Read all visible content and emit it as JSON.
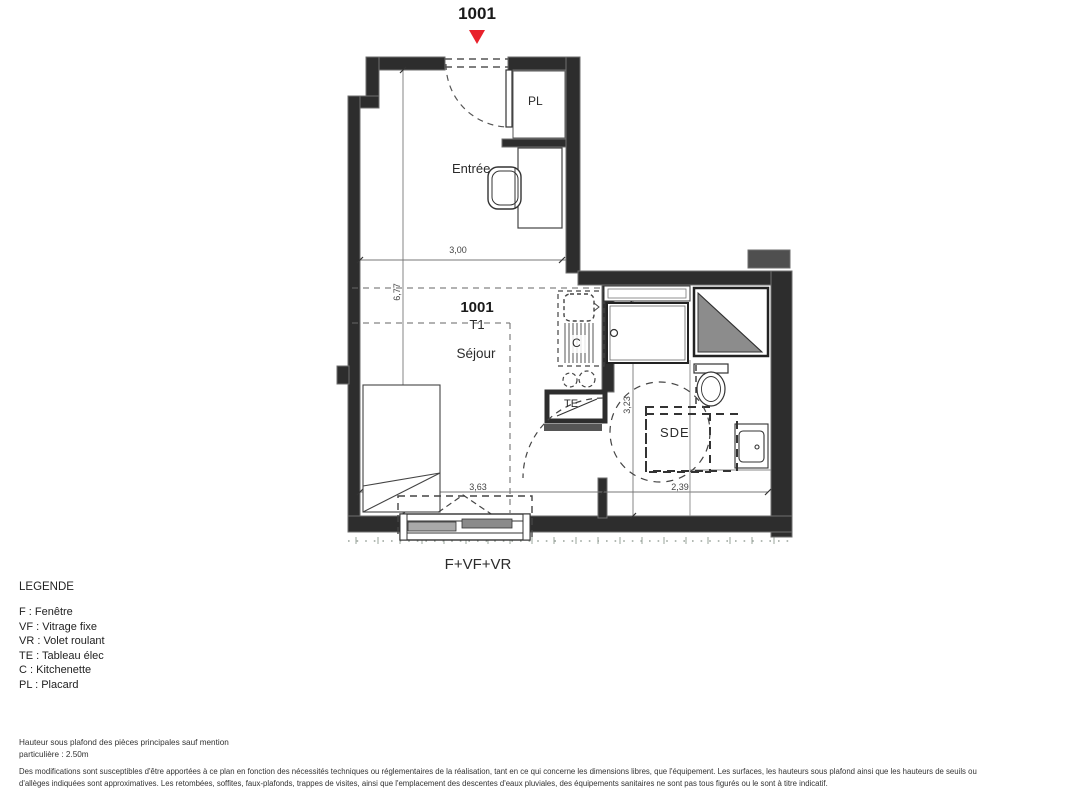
{
  "header": {
    "unit_number": "1001"
  },
  "plan": {
    "labels": {
      "closet": "PL",
      "entry": "Entrée",
      "unit": "1001",
      "type": "T1",
      "living": "Séjour",
      "kitchenette": "C",
      "elec_panel": "TE",
      "shower_room": "SDE",
      "window": "F+VF+VR"
    },
    "dimensions": {
      "top_width": "3,00",
      "left_height": "6,77",
      "sde_height": "3,23",
      "bottom_left": "3,63",
      "bottom_right": "2,39"
    }
  },
  "legend": {
    "title": "LEGENDE",
    "items": [
      "F : Fenêtre",
      "VF : Vitrage fixe",
      "VR : Volet roulant",
      "TE : Tableau élec",
      "C : Kitchenette",
      "PL : Placard"
    ]
  },
  "notes": {
    "ceiling_line1": "Hauteur sous plafond des pièces principales sauf mention",
    "ceiling_line2": "particulière : 2.50m",
    "disclaimer_line1": "Des modifications sont susceptibles d'être apportées à ce plan en fonction des nécessités techniques ou réglementaires de la réalisation, tant en ce qui concerne les dimensions libres, que l'équipement. Les surfaces, les hauteurs sous plafond ainsi que les hauteurs de seuils ou",
    "disclaimer_line2": "d'allèges indiquées sont approximatives. Les retombées, soffites, faux-plafonds, trappes de visites, ainsi que l'emplacement des descentes d'eaux pluviales, des équipements sanitaires ne sont pas tous figurés ou le sont à titre indicatif."
  },
  "colors": {
    "wall": "#2d2d2d",
    "marker_red": "#e8212b",
    "duct_gray": "#8c8c8c",
    "dashed_line": "#555555"
  }
}
